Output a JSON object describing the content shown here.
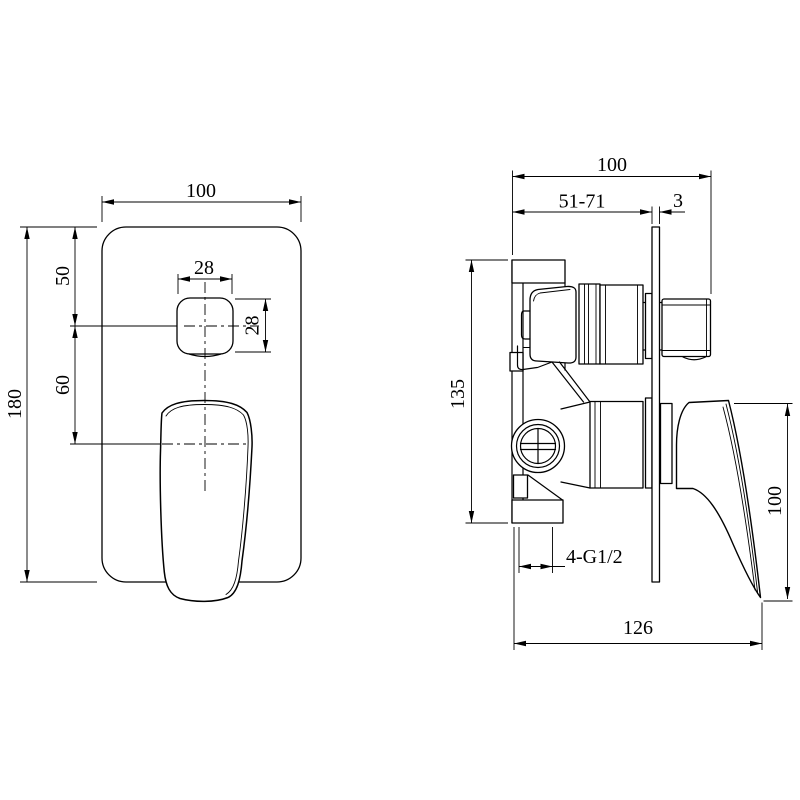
{
  "drawing": {
    "background": "#ffffff",
    "line_color": "#000000",
    "views": {
      "front": {
        "width_mm": "100",
        "height_mm": "180",
        "plate_top_to_button_mm": "50",
        "button_to_handle_mm": "60",
        "button_width_mm": "28",
        "button_height_mm": "28"
      },
      "side": {
        "overall_depth_mm": "100",
        "installation_depth_mm": "51-71",
        "plate_thickness_mm": "3",
        "body_height_mm": "135",
        "handle_drop_mm": "100",
        "overall_width_mm": "126",
        "connections": "4-G1/2"
      }
    }
  }
}
